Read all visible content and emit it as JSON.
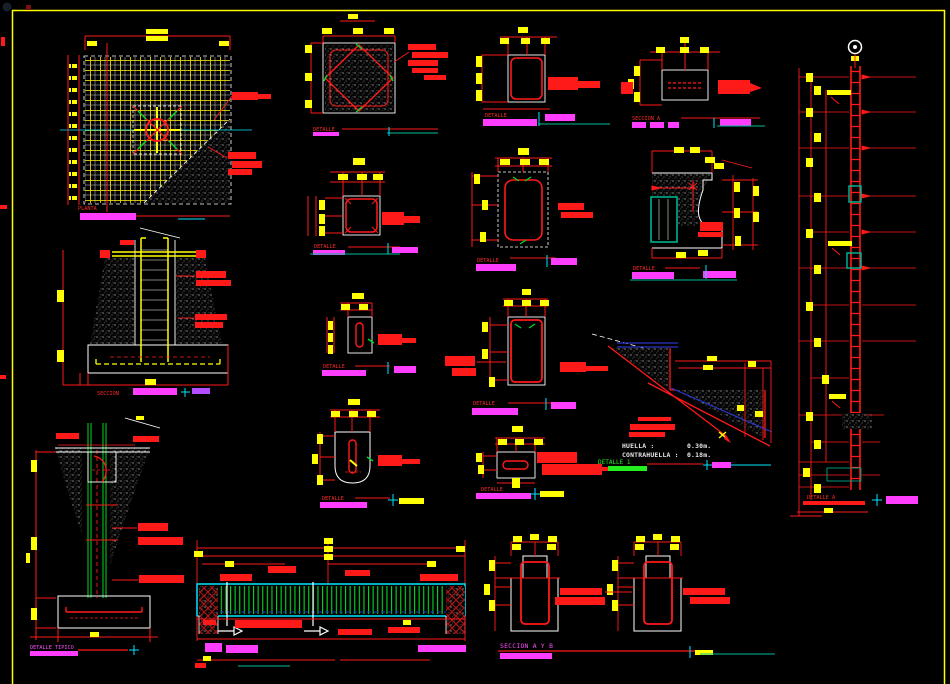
{
  "canvas": {
    "width": 950,
    "height": 684,
    "background": "#000000"
  },
  "palette": {
    "line_red": "#ff1a1a",
    "dim_yellow": "#ffff00",
    "label_magenta": "#ff3dff",
    "axis_cyan": "#00e5ff",
    "stirrup_green": "#00d926",
    "rebar_blue": "#2a35c8",
    "outline_white": "#ffffff",
    "sheet_border_yellow": "#ffff00"
  },
  "labels": {
    "planta": "PLANTA",
    "seccion": "SECCION",
    "detalle": "DETALLE",
    "detalle_tipico": "DETALLE TIPICO",
    "detalle_a": "DETALLE A",
    "detalle_1": "DETALLE 1",
    "seccion_a": "SECCION    A",
    "seccion_a_y_b": "SECCION   A Y B"
  },
  "stair_detail": {
    "huella_label": "HUELLA :",
    "huella_value": "0.30m.",
    "contrahuella_label": "CONTRAHUELLA :",
    "contrahuella_value": "0.18m."
  }
}
